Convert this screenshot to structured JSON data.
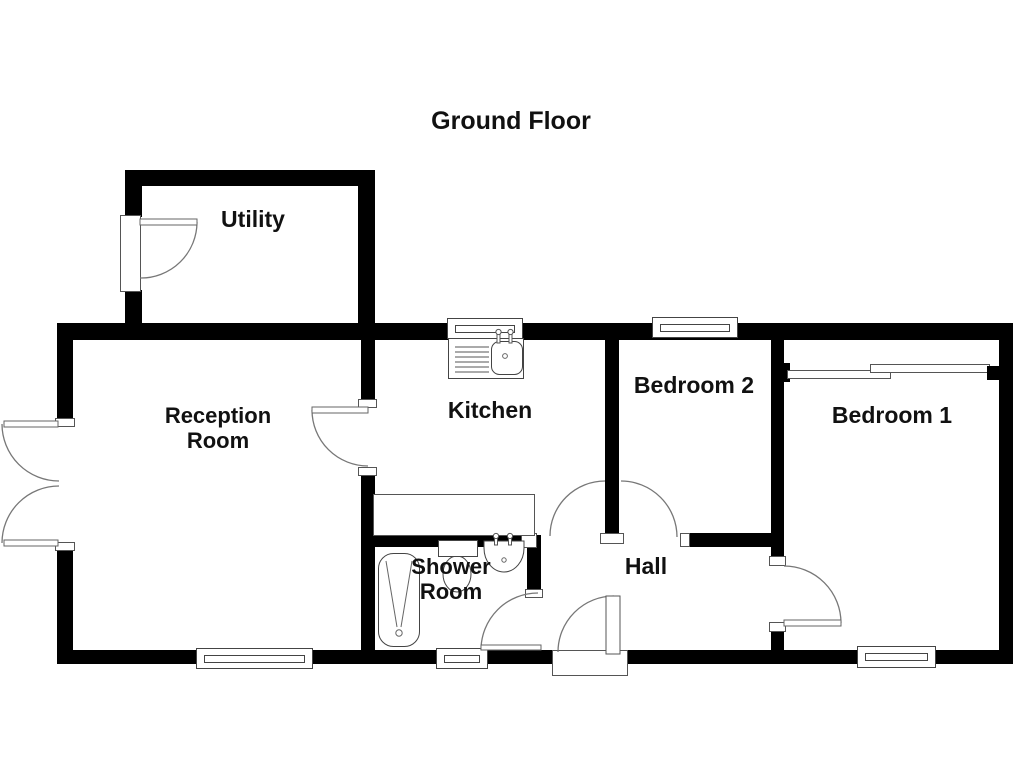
{
  "title": "Ground Floor",
  "rooms": [
    {
      "id": "utility",
      "label": "Utility"
    },
    {
      "id": "reception-room",
      "label": "Reception Room"
    },
    {
      "id": "kitchen",
      "label": "Kitchen"
    },
    {
      "id": "bedroom-2",
      "label": "Bedroom 2"
    },
    {
      "id": "bedroom-1",
      "label": "Bedroom 1"
    },
    {
      "id": "shower-room",
      "label": "Shower Room"
    },
    {
      "id": "hall",
      "label": "Hall"
    }
  ],
  "fixtures": [
    "bathtub-icon",
    "toilet-icon",
    "wash-basin-icon",
    "kitchen-sink-icon",
    "worktop-icon",
    "sliding-wardrobe-icon",
    "door-swing-icon",
    "window-icon"
  ],
  "colors": {
    "wall": "#000000",
    "fixture_line": "#666666",
    "text": "#111111",
    "background": "#ffffff"
  }
}
